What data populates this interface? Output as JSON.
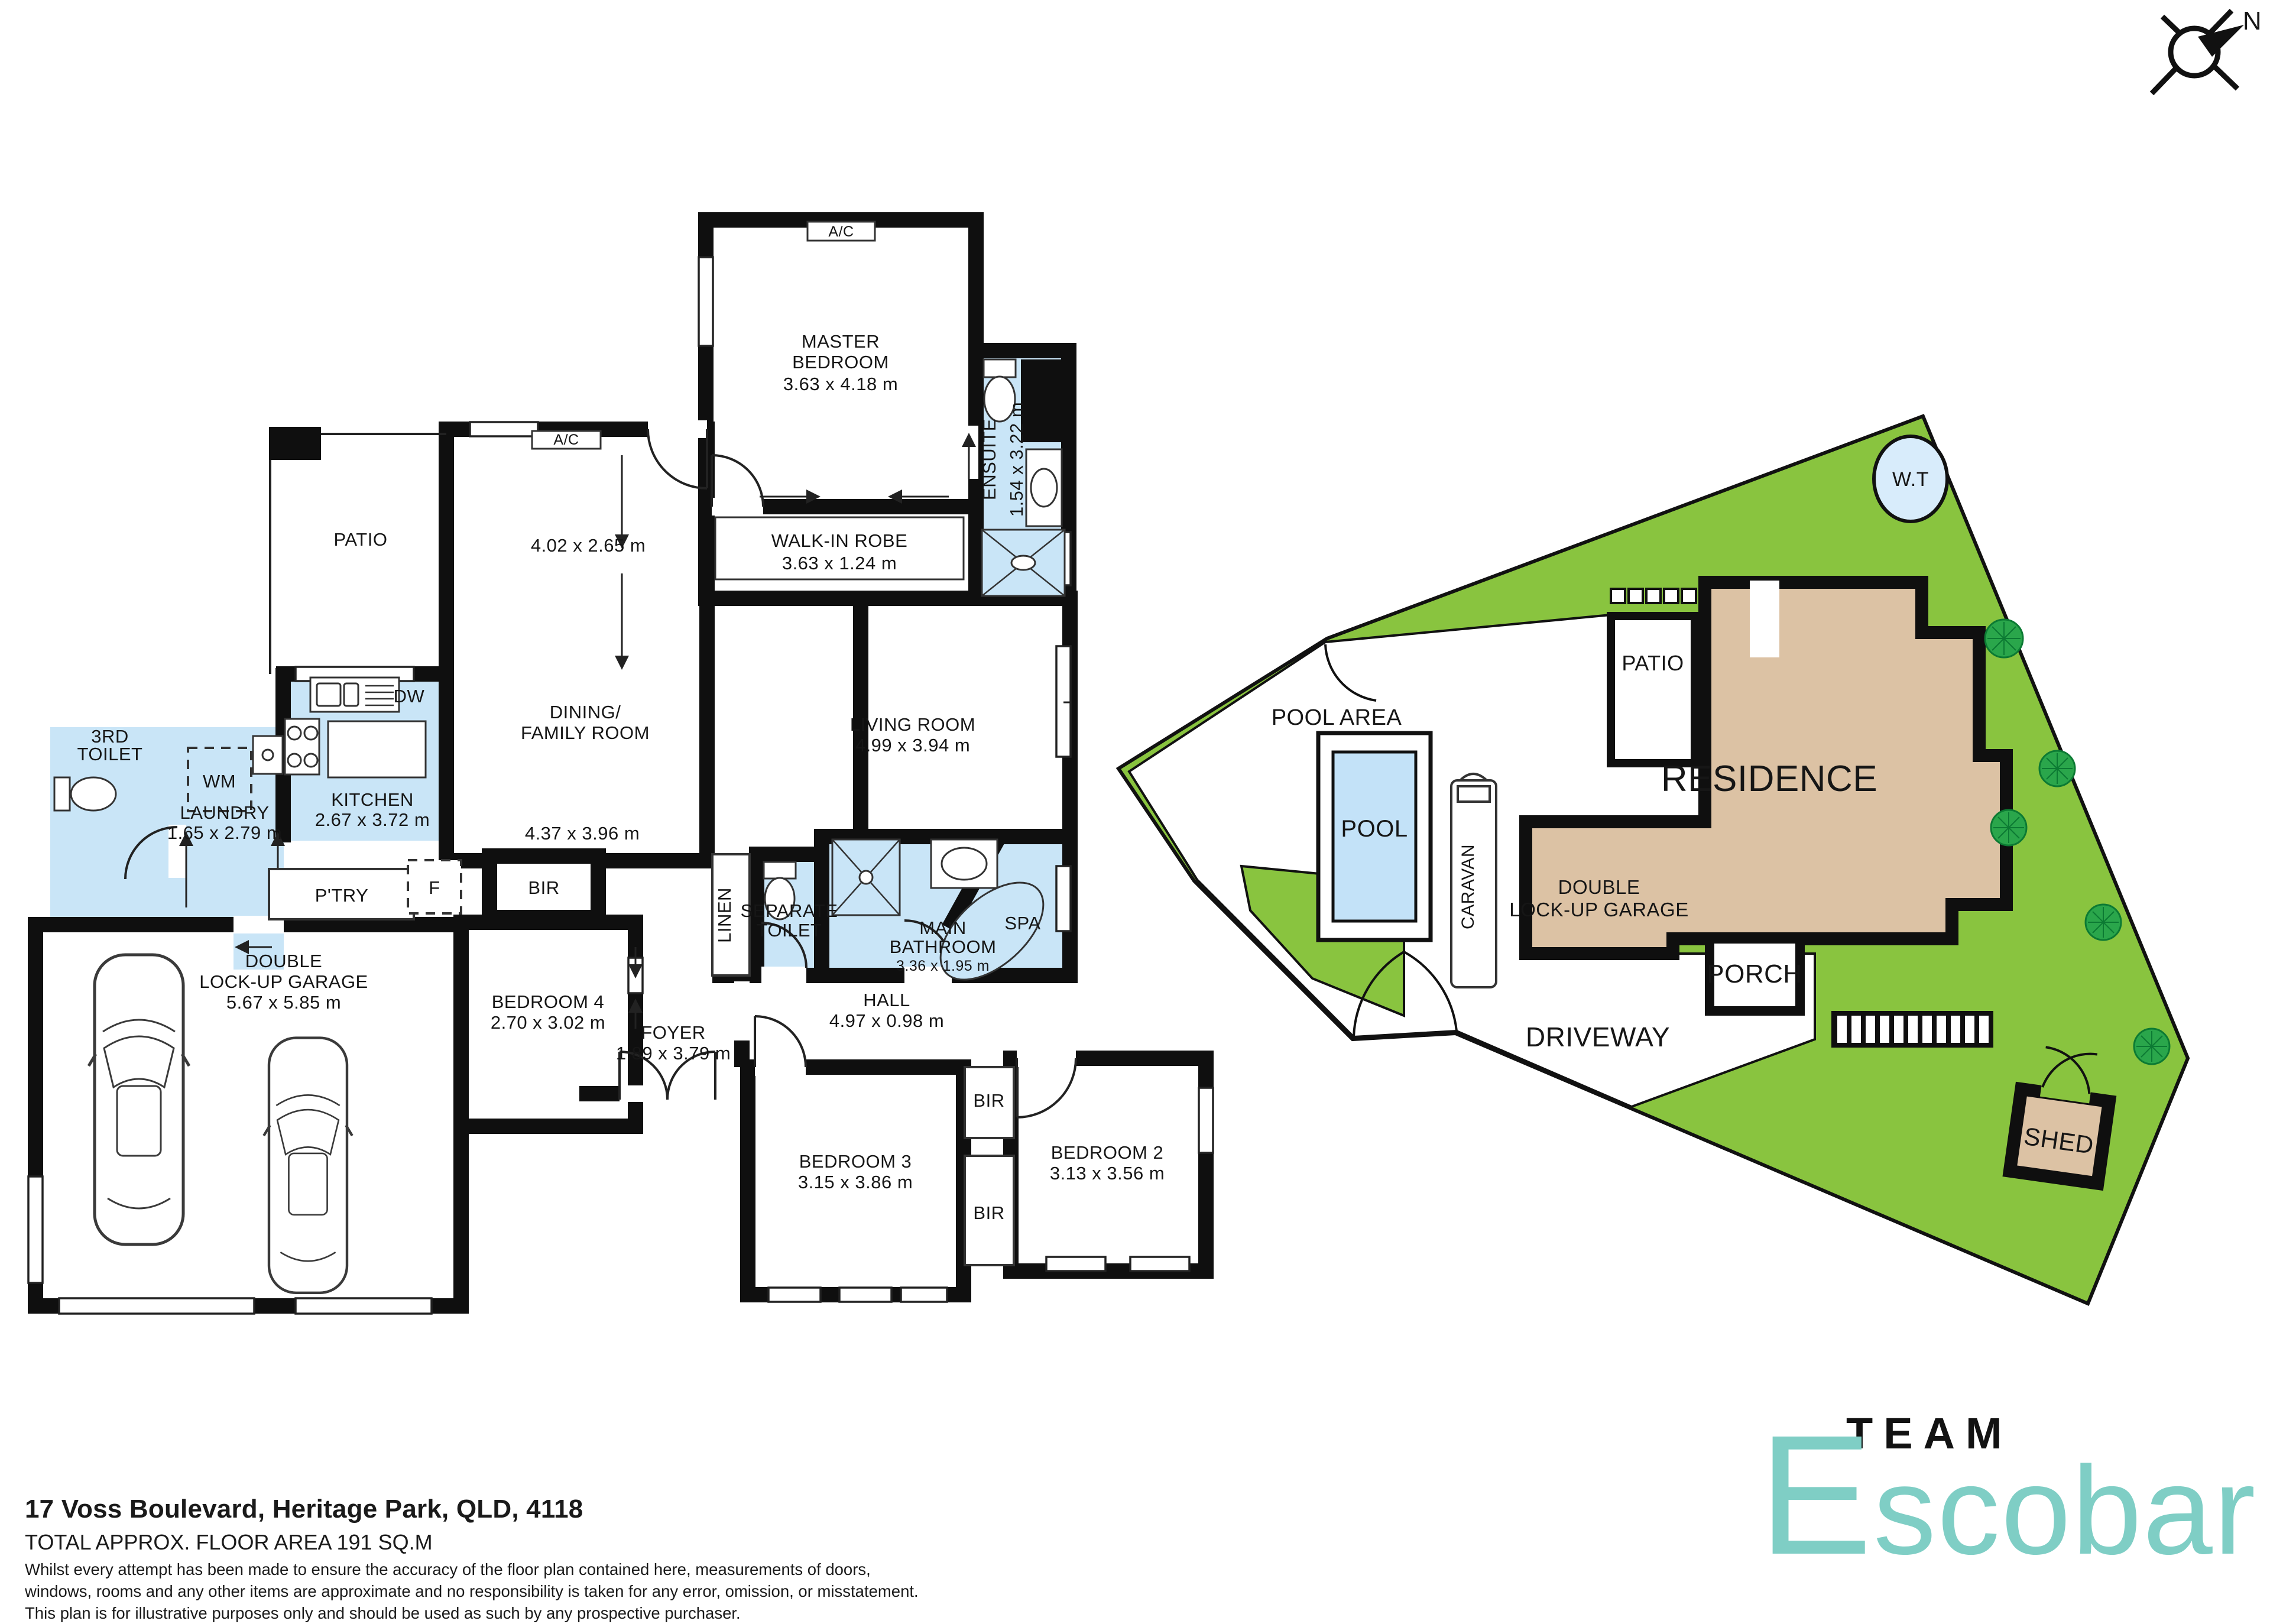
{
  "compass": {
    "n": "N"
  },
  "fp": {
    "ac": "A/C",
    "dw": "DW",
    "wm": "WM",
    "f": "F",
    "ptry": "P'TRY",
    "bir": "BIR",
    "linen": "LINEN",
    "spa": "SPA",
    "patio": "PATIO",
    "master": [
      "MASTER",
      "BEDROOM",
      "3.63 x 4.18 m"
    ],
    "ensuite": [
      "ENSUITE",
      "1.54 x 3.22 m"
    ],
    "robe": [
      "WALK-IN ROBE",
      "3.63 x 1.24 m"
    ],
    "dining": [
      "4.02 x 2.65 m",
      "DINING/",
      "FAMILY ROOM",
      "4.37 x 3.96 m"
    ],
    "living": [
      "LIVING ROOM",
      "4.99 x 3.94 m"
    ],
    "kitchen": [
      "KITCHEN",
      "2.67 x 3.72 m"
    ],
    "laundry": [
      "LAUNDRY",
      "1.65 x 2.79 m"
    ],
    "toilet3": [
      "3RD",
      "TOILET"
    ],
    "sep_toilet": [
      "SEPARATE",
      "TOILET"
    ],
    "main_bath": [
      "MAIN",
      "BATHROOM",
      "3.36 x 1.95 m"
    ],
    "hall": [
      "HALL",
      "4.97 x 0.98 m"
    ],
    "foyer": [
      "FOYER",
      "1.89 x 3.79 m"
    ],
    "garage": [
      "DOUBLE",
      "LOCK-UP GARAGE",
      "5.67 x 5.85 m"
    ],
    "bed4": [
      "BEDROOM 4",
      "2.70 x 3.02 m"
    ],
    "bed3": [
      "BEDROOM 3",
      "3.15 x 3.86 m"
    ],
    "bed2": [
      "BEDROOM 2",
      "3.13 x 3.56 m"
    ]
  },
  "site": {
    "pool_area": "POOL AREA",
    "pool": "POOL",
    "caravan": "CARAVAN",
    "patio": "PATIO",
    "residence": "RESIDENCE",
    "garage": [
      "DOUBLE",
      "LOCK-UP GARAGE"
    ],
    "porch": "PORCH",
    "driveway": "DRIVEWAY",
    "shed": "SHED",
    "wt": "W.T"
  },
  "footer": {
    "address": "17 Voss Boulevard, Heritage Park, QLD, 4118",
    "area": "TOTAL APPROX. FLOOR AREA 191 SQ.M",
    "disclaimer": [
      "Whilst every attempt has been made to ensure the accuracy of the floor plan contained here, measurements of doors,",
      "windows, rooms and any other items are approximate and no responsibility is taken for any error, omission, or misstatement.",
      "This plan is for illustrative purposes only and should be used as such by any prospective purchaser."
    ]
  },
  "brand": {
    "team": "TEAM",
    "name_initial": "E",
    "name_rest": "scobar"
  },
  "colors": {
    "wall": "#0f0f0f",
    "wet_blue": "#c9e5f7",
    "pool_blue": "#c3e2f8",
    "tank_blue": "#d8ecfb",
    "lawn_green": "#89c43f",
    "tree_green": "#2aa64b",
    "residence_tan": "#dcc2a4",
    "brand_teal": "#7fcec5"
  }
}
